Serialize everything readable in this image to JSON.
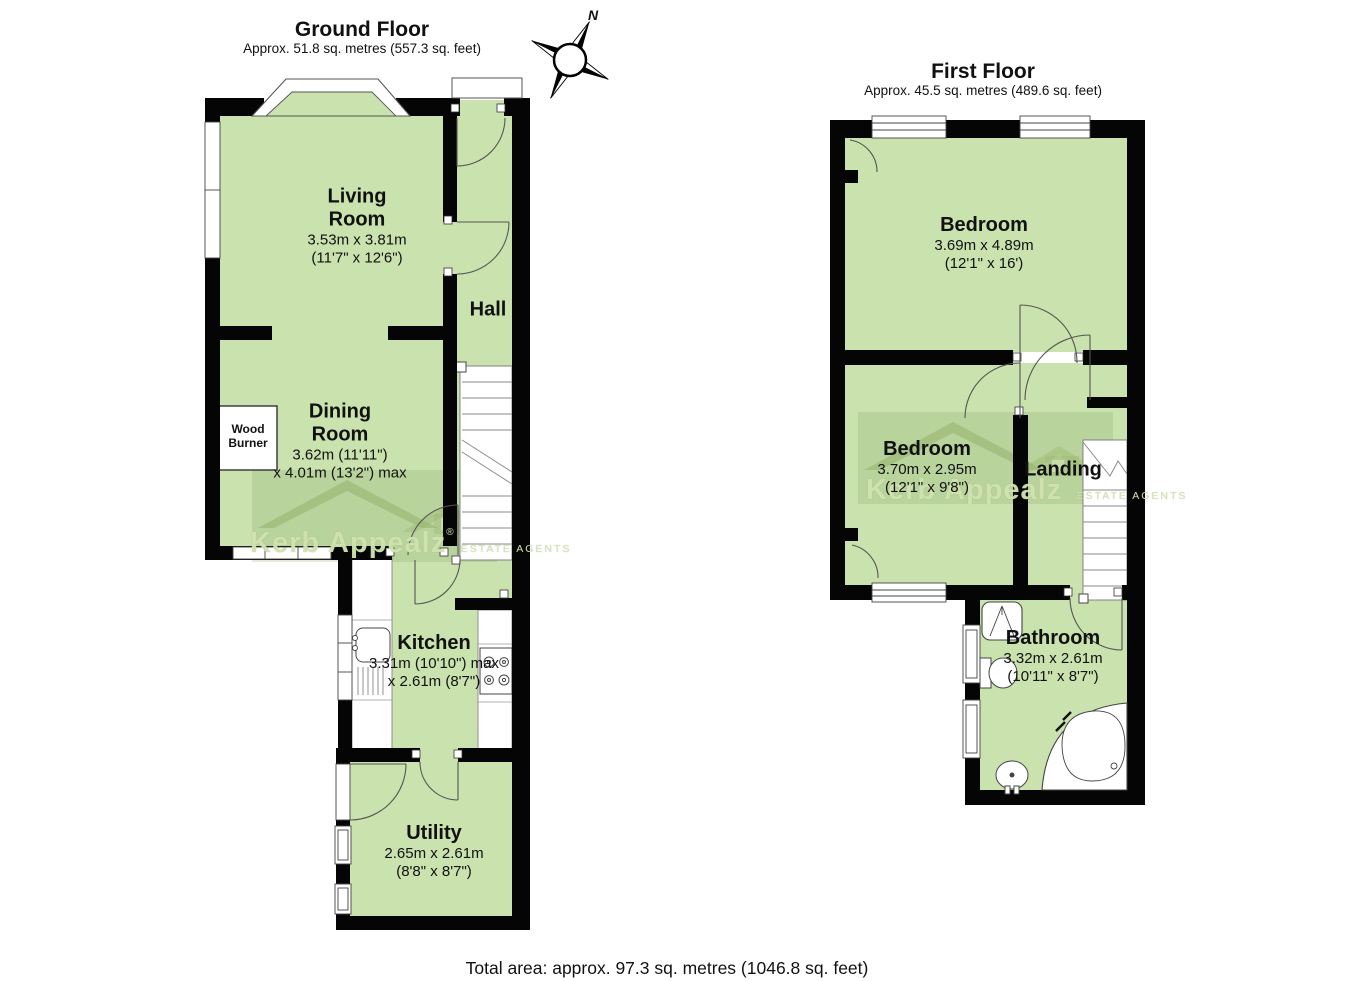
{
  "page": {
    "total_area": "Total area: approx. 97.3 sq. metres (1046.8 sq. feet)",
    "compass_north": "N"
  },
  "watermark": {
    "brand": "Kerb Appealz",
    "reg": "®",
    "tagline": "ESTATE AGENTS"
  },
  "ground_floor": {
    "title": "Ground Floor",
    "subtitle": "Approx. 51.8 sq. metres (557.3 sq. feet)",
    "rooms": {
      "living_room": {
        "name": "Living\nRoom",
        "size_metric": "3.53m x 3.81m",
        "size_imperial": "(11'7\" x 12'6\")"
      },
      "dining_room": {
        "name": "Dining\nRoom",
        "size_metric": "3.62m (11'11\")",
        "size_imperial": "x 4.01m (13'2\") max"
      },
      "hall": {
        "name": "Hall"
      },
      "kitchen": {
        "name": "Kitchen",
        "size_metric": "3.31m (10'10\") max",
        "size_imperial": "x 2.61m (8'7\")"
      },
      "utility": {
        "name": "Utility",
        "size_metric": "2.65m x 2.61m",
        "size_imperial": "(8'8\" x 8'7\")"
      },
      "wood_burner": {
        "name": "Wood\nBurner"
      }
    }
  },
  "first_floor": {
    "title": "First Floor",
    "subtitle": "Approx. 45.5 sq. metres (489.6 sq. feet)",
    "rooms": {
      "bedroom_front": {
        "name": "Bedroom",
        "size_metric": "3.69m x 4.89m",
        "size_imperial": "(12'1\" x 16')"
      },
      "bedroom_back": {
        "name": "Bedroom",
        "size_metric": "3.70m x 2.95m",
        "size_imperial": "(12'1\" x 9'8\")"
      },
      "landing": {
        "name": "Landing"
      },
      "bathroom": {
        "name": "Bathroom",
        "size_metric": "3.32m x 2.61m",
        "size_imperial": "(10'11\" x 8'7\")"
      }
    }
  },
  "colors": {
    "room_fill": "#c9e2ae",
    "wall": "#000000",
    "watermark_green": "#a9c488"
  }
}
